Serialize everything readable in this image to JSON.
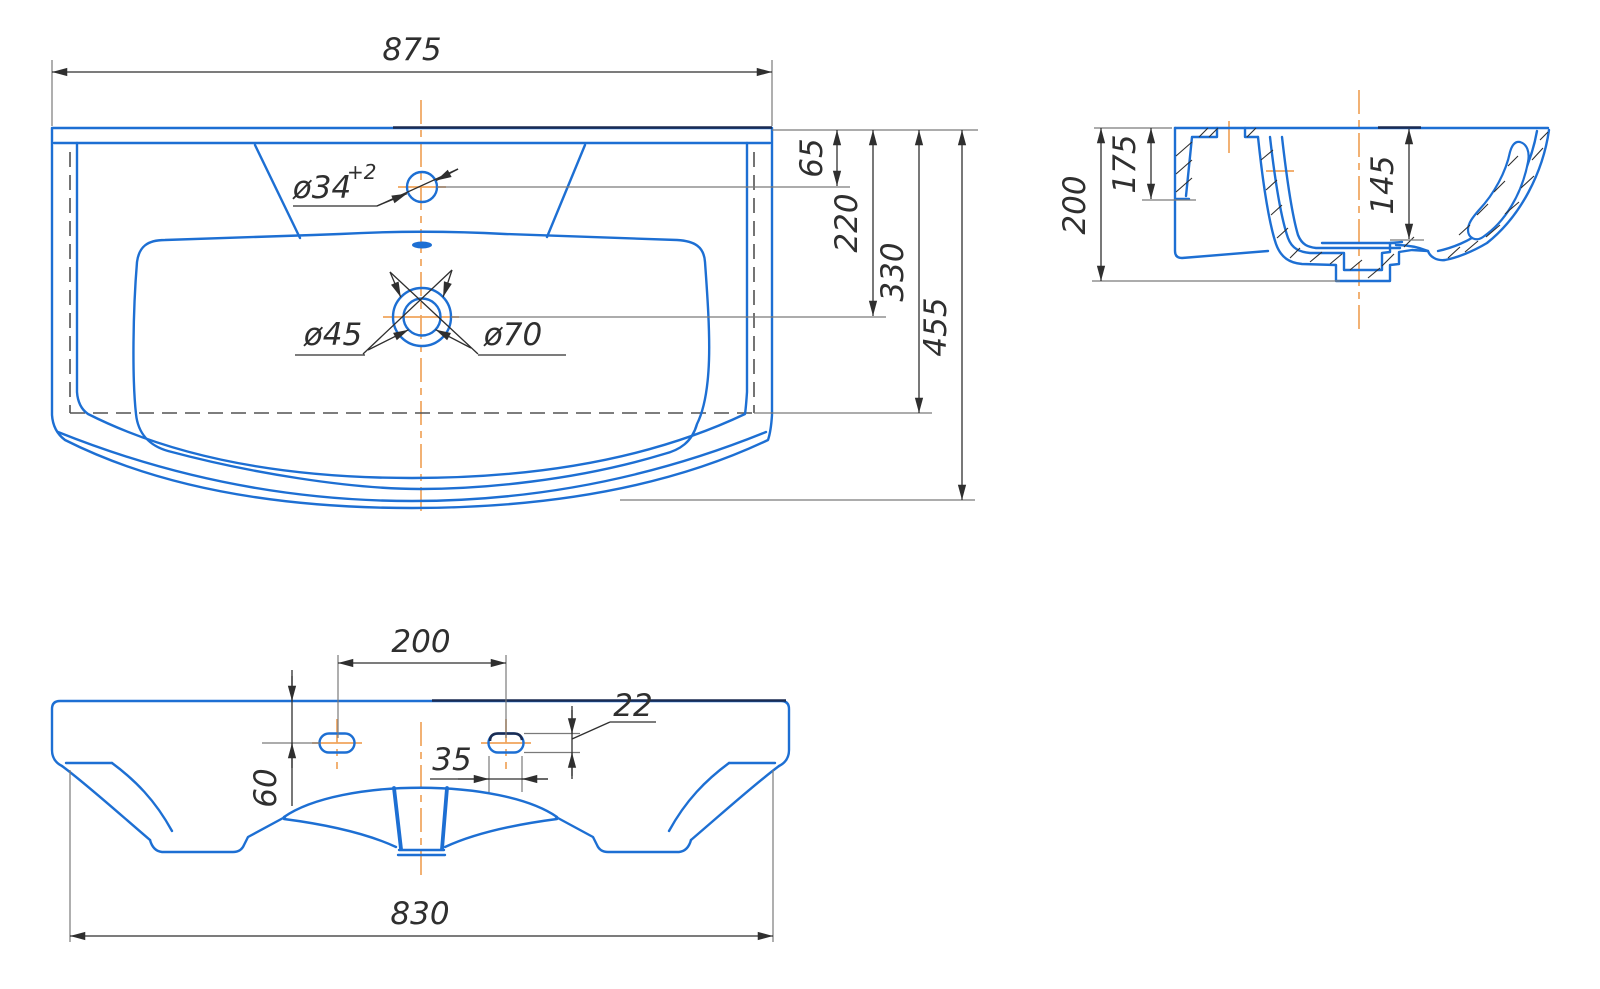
{
  "colors": {
    "blue": "#1d6fd3",
    "navy": "#1b2c52",
    "center": "#f0a45c",
    "dashed": "#525252",
    "gray": "#7a7a7a",
    "dim": "#2f2f2f"
  },
  "top_view": {
    "overall_width": "875",
    "faucet_hole_dia": "ø34",
    "faucet_hole_tolerance": "+2",
    "faucet_depth": "65",
    "drain_depth": "220",
    "bowl_rear_depth": "330",
    "overall_depth": "455",
    "drain_inner_dia": "ø45",
    "drain_outer_dia": "ø70"
  },
  "section_view": {
    "overall_height": "200",
    "rear_height": "175",
    "bowl_depth": "145"
  },
  "front_view": {
    "hole_spacing": "200",
    "hole_height": "22",
    "hole_width": "35",
    "hole_top_offset": "60",
    "mounting_width": "830"
  }
}
